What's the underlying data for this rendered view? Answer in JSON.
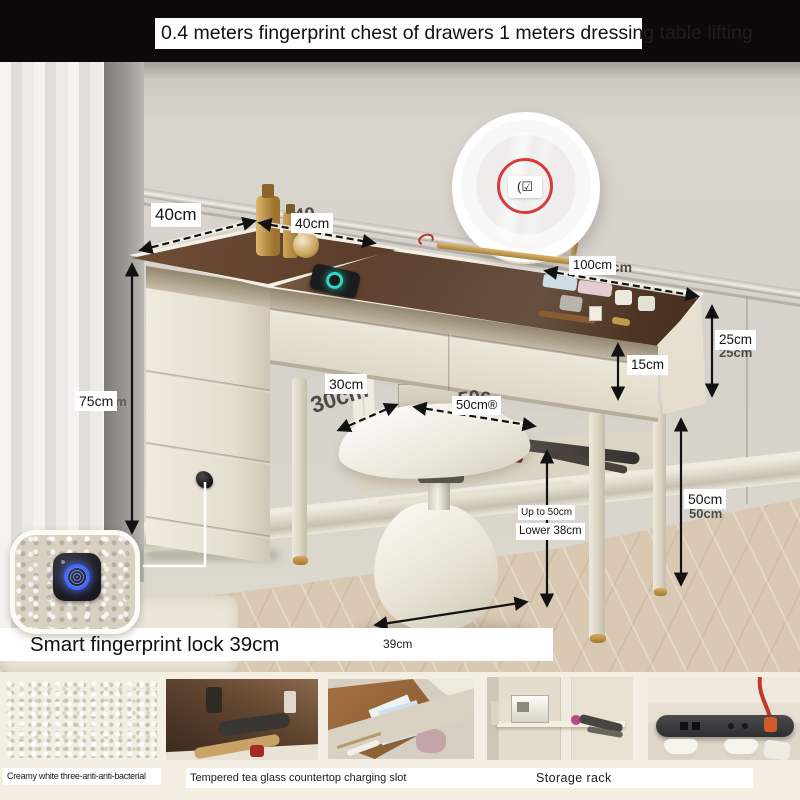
{
  "header": {
    "title": "0.4 meters fingerprint chest of drawers   1 meters dressing table   lifting"
  },
  "annotations": {
    "chest_height": "75cm",
    "chest_depth": "40cm",
    "table_depth": "40cm",
    "table_width": "100cm",
    "side_panel_height": "25cm",
    "drawer_height": "15cm",
    "stool_depth": "30cm",
    "stool_width": "50cm®",
    "seat_up": "Up to 50cm",
    "seat_low": "Lower 38cm",
    "leg_height": "50cm",
    "stool_base_width": "39cm",
    "lock_caption": "Smart fingerprint lock 39cm",
    "mirror_touch_icon": "(☑"
  },
  "watermarks": {
    "w40": "40",
    "d30": "30cm",
    "w50": "50c",
    "w100": "0cm",
    "h25": "25cm",
    "h50": "50cm",
    "h75": "cm"
  },
  "footer": {
    "captions": {
      "leather": "Creamy white three-anti-anti-bacterial",
      "glass": "Tempered tea glass countertop charging slot",
      "rack": "Storage rack"
    },
    "thumbs": [
      {
        "name": "creamy-white-leather-swatch"
      },
      {
        "name": "tempered-tea-glass-countertop"
      },
      {
        "name": "drawer-interior"
      },
      {
        "name": "storage-rack"
      },
      {
        "name": "charging-power-strip"
      }
    ]
  },
  "colors": {
    "accent_gold": "#c9a45f",
    "glass_brown": "#5a3d2a",
    "annotation_red": "#d8393b",
    "lock_ring_blue": "#4468ff",
    "charger_teal": "#2ed8c6"
  }
}
